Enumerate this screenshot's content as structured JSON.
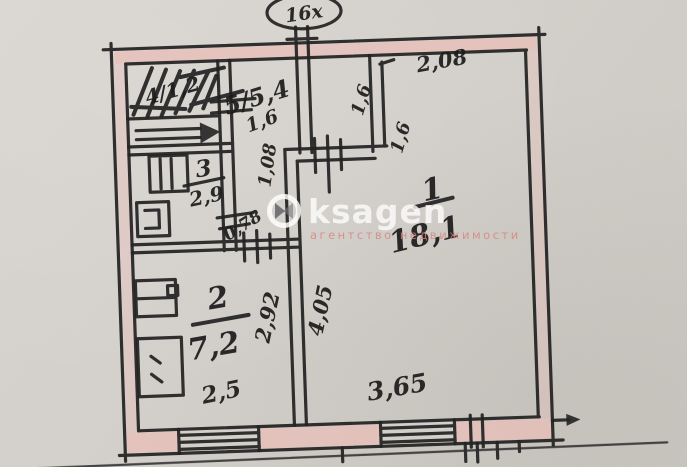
{
  "plan": {
    "apartment_bubble": "16х",
    "rooms": {
      "room1_number": "1",
      "room1_area": "18,1",
      "room2_number": "2",
      "room2_area": "7,2",
      "room3_number": "3",
      "room3_area": "2,9",
      "room4_label": "4/1,2",
      "room5_label": "5/5,4"
    },
    "dimensions": {
      "d_2_08": "2,08",
      "d_1_6_top": "1,6",
      "d_1_6_wall_upper": "1,6",
      "d_1_6_wall_lower": "1,6",
      "d_1_08": "1,08",
      "d_0_78": "0,78",
      "d_2_92": "2,92",
      "d_4_05": "4,05",
      "d_2_5": "2,5",
      "d_3_65": "3,65"
    },
    "colors": {
      "ink": "#232323",
      "wall_fill_pink": "#e7c0b9",
      "paper": "#d3cfca"
    }
  },
  "watermark": {
    "brand": "ksagen",
    "tagline": "агентство недвижимости"
  }
}
